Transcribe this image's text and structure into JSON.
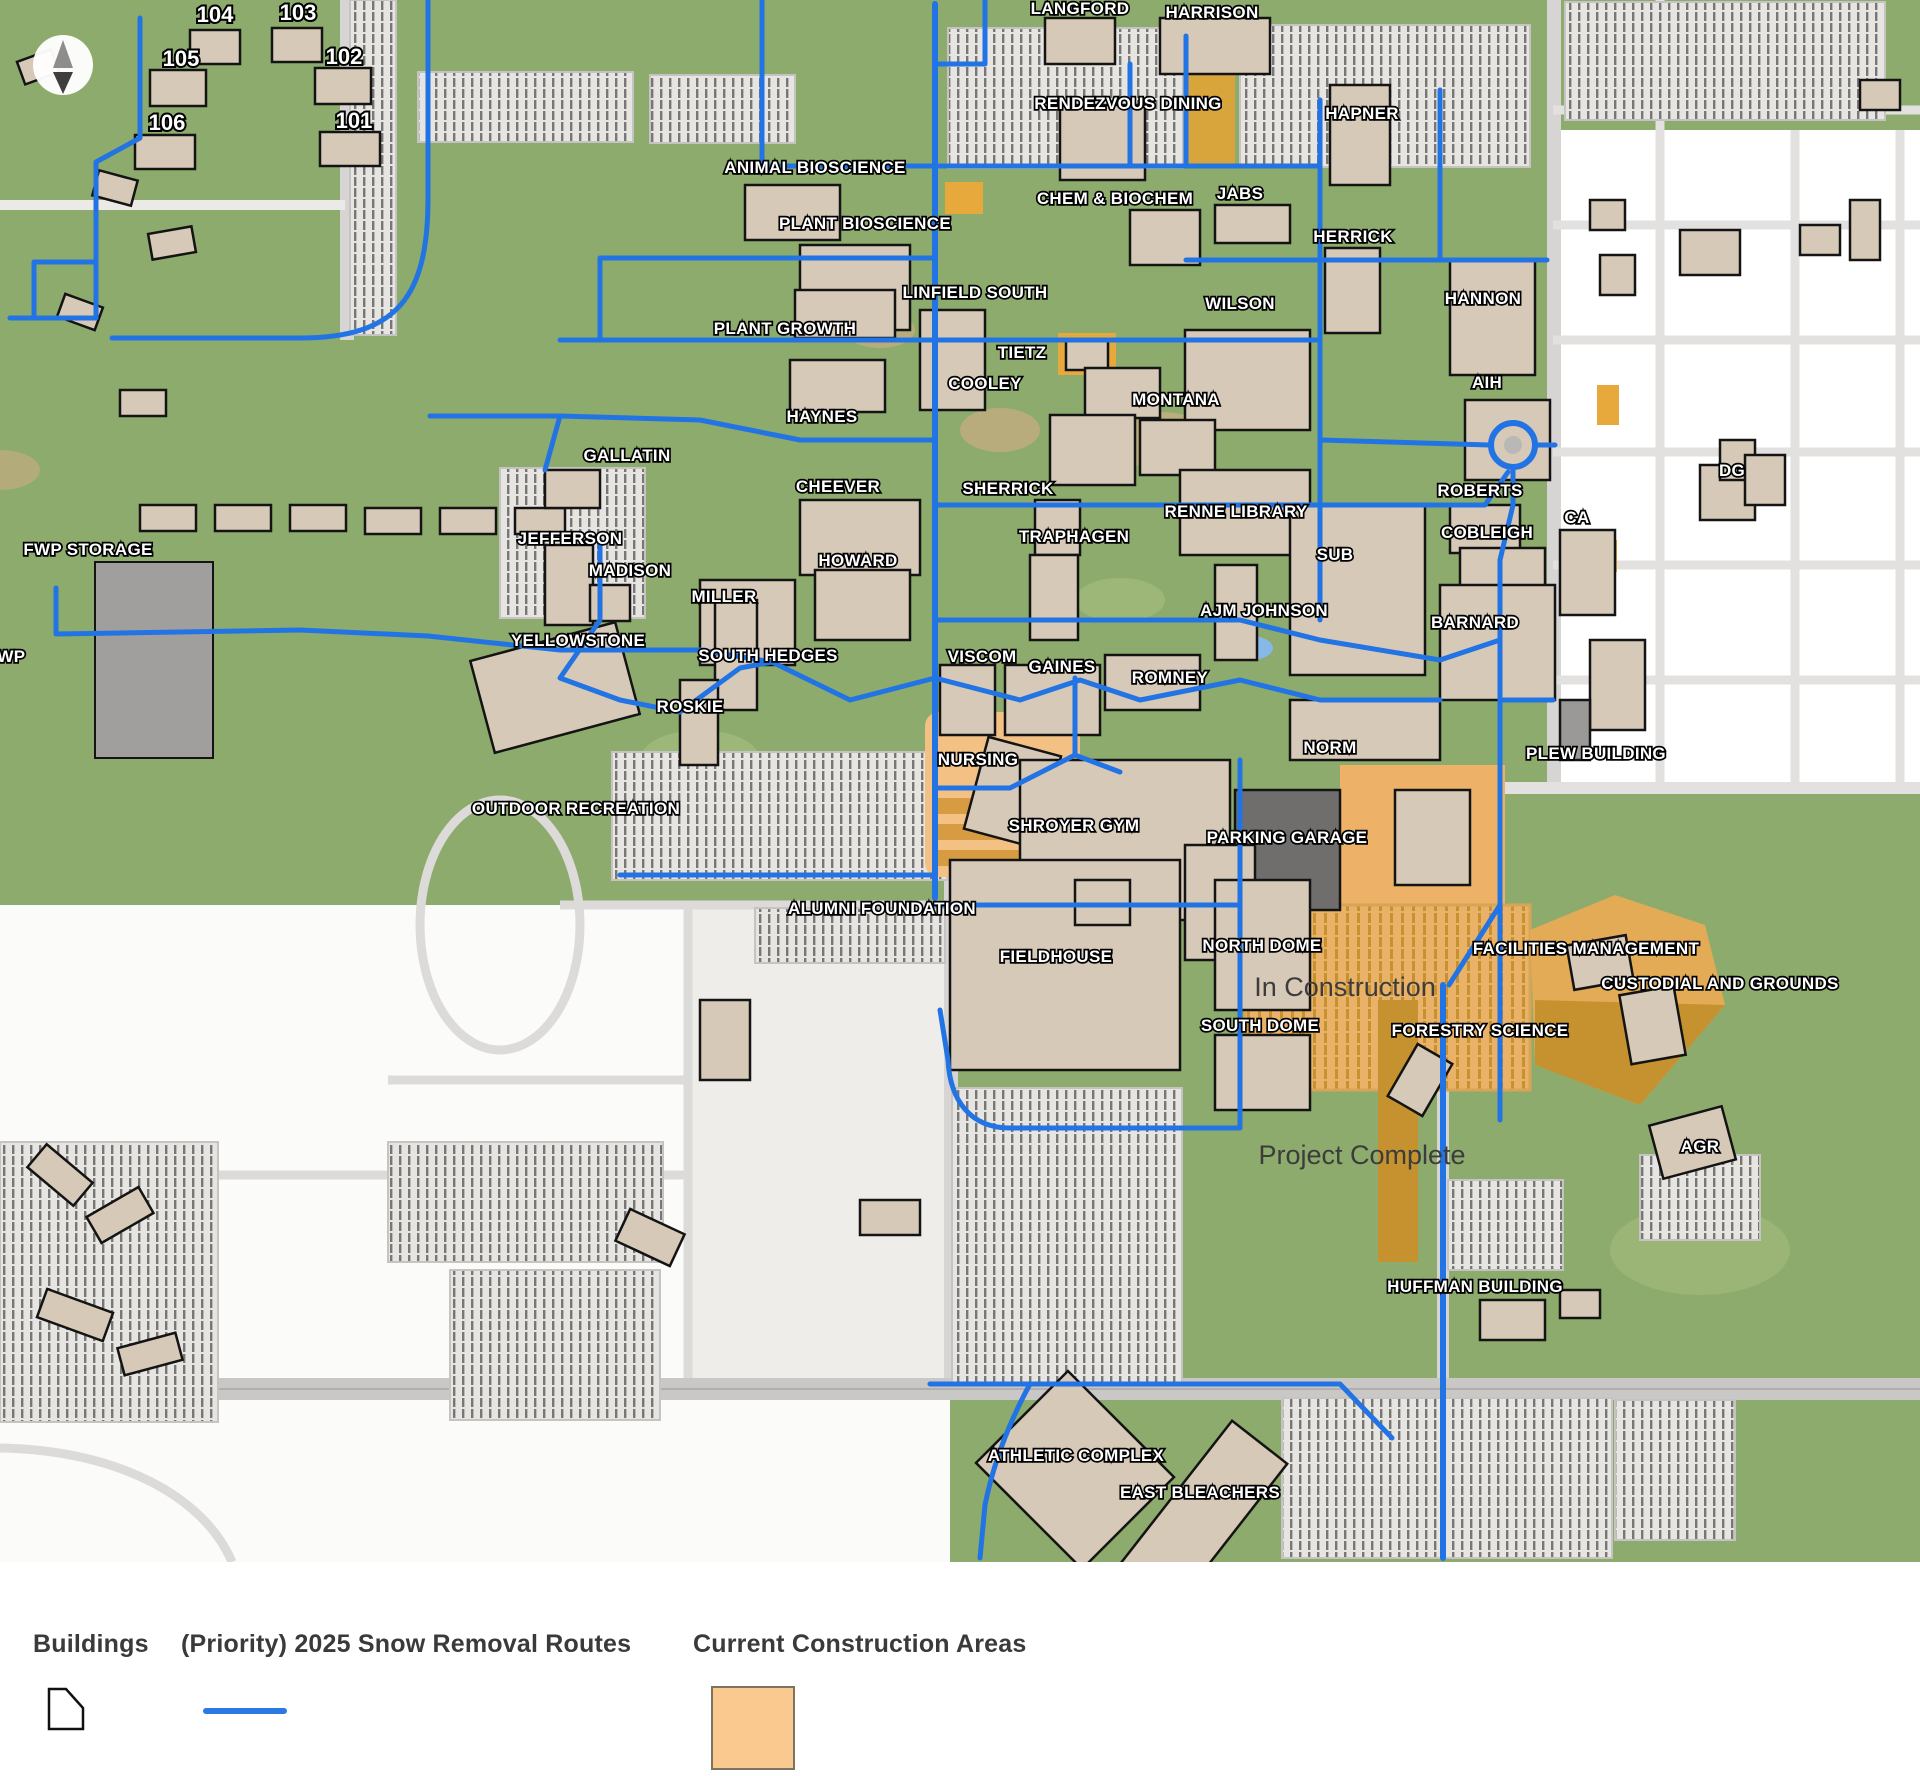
{
  "map": {
    "colors": {
      "campus_green": "#8dab6d",
      "route_blue": "#2274e4",
      "building_tan": "#d7c9b8",
      "construction_light": "#f4c184",
      "construction_mid": "#e9b268",
      "construction_dark": "#c5922f",
      "street_gray": "#d6d5d3",
      "parking_gray": "#e7e5e2"
    },
    "labels": [
      {
        "t": "104",
        "x": 215,
        "y": 16,
        "k": "n"
      },
      {
        "t": "103",
        "x": 298,
        "y": 14,
        "k": "n"
      },
      {
        "t": "105",
        "x": 181,
        "y": 60,
        "k": "n"
      },
      {
        "t": "102",
        "x": 344,
        "y": 58,
        "k": "n"
      },
      {
        "t": "106",
        "x": 167,
        "y": 124,
        "k": "n"
      },
      {
        "t": "101",
        "x": 354,
        "y": 122,
        "k": "n"
      },
      {
        "t": "LANGFORD",
        "x": 1080,
        "y": 8,
        "k": "b"
      },
      {
        "t": "HARRISON",
        "x": 1212,
        "y": 12,
        "k": "b"
      },
      {
        "t": "RENDEZVOUS DINING",
        "x": 1128,
        "y": 103,
        "k": "b"
      },
      {
        "t": "HAPNER",
        "x": 1362,
        "y": 113,
        "k": "b"
      },
      {
        "t": "ANIMAL BIOSCIENCE",
        "x": 815,
        "y": 167,
        "k": "b"
      },
      {
        "t": "CHEM & BIOCHEM",
        "x": 1115,
        "y": 198,
        "k": "b"
      },
      {
        "t": "JABS",
        "x": 1240,
        "y": 193,
        "k": "b"
      },
      {
        "t": "PLANT BIOSCIENCE",
        "x": 865,
        "y": 223,
        "k": "b"
      },
      {
        "t": "HERRICK",
        "x": 1353,
        "y": 236,
        "k": "b"
      },
      {
        "t": "LINFIELD SOUTH",
        "x": 975,
        "y": 292,
        "k": "b"
      },
      {
        "t": "WILSON",
        "x": 1240,
        "y": 303,
        "k": "b"
      },
      {
        "t": "HANNON",
        "x": 1483,
        "y": 298,
        "k": "b"
      },
      {
        "t": "PLANT GROWTH",
        "x": 785,
        "y": 328,
        "k": "b"
      },
      {
        "t": "TIETZ",
        "x": 1022,
        "y": 352,
        "k": "b"
      },
      {
        "t": "COOLEY",
        "x": 985,
        "y": 383,
        "k": "b"
      },
      {
        "t": "MONTANA",
        "x": 1176,
        "y": 399,
        "k": "b"
      },
      {
        "t": "AIH",
        "x": 1487,
        "y": 382,
        "k": "b"
      },
      {
        "t": "HAYNES",
        "x": 822,
        "y": 416,
        "k": "b"
      },
      {
        "t": "GALLATIN",
        "x": 627,
        "y": 455,
        "k": "b"
      },
      {
        "t": "CHEEVER",
        "x": 838,
        "y": 486,
        "k": "b"
      },
      {
        "t": "SHERRICK",
        "x": 1008,
        "y": 488,
        "k": "b"
      },
      {
        "t": "RENNE LIBRARY",
        "x": 1236,
        "y": 511,
        "k": "b"
      },
      {
        "t": "ROBERTS",
        "x": 1480,
        "y": 490,
        "k": "b"
      },
      {
        "t": "TRAPHAGEN",
        "x": 1074,
        "y": 536,
        "k": "b"
      },
      {
        "t": "COBLEIGH",
        "x": 1487,
        "y": 532,
        "k": "b"
      },
      {
        "t": "CA",
        "x": 1577,
        "y": 517,
        "k": "b"
      },
      {
        "t": "DG",
        "x": 1732,
        "y": 470,
        "k": "b"
      },
      {
        "t": "FWP STORAGE",
        "x": 88,
        "y": 549,
        "k": "b"
      },
      {
        "t": "JEFFERSON",
        "x": 570,
        "y": 538,
        "k": "b"
      },
      {
        "t": "MADISON",
        "x": 630,
        "y": 570,
        "k": "b"
      },
      {
        "t": "HOWARD",
        "x": 858,
        "y": 560,
        "k": "b"
      },
      {
        "t": "SUB",
        "x": 1335,
        "y": 554,
        "k": "b"
      },
      {
        "t": "MILLER",
        "x": 724,
        "y": 596,
        "k": "b"
      },
      {
        "t": "AJM JOHNSON",
        "x": 1264,
        "y": 610,
        "k": "b"
      },
      {
        "t": "BARNARD",
        "x": 1475,
        "y": 622,
        "k": "b"
      },
      {
        "t": "FWP",
        "x": 6,
        "y": 656,
        "k": "b"
      },
      {
        "t": "YELLOWSTONE",
        "x": 578,
        "y": 640,
        "k": "b"
      },
      {
        "t": "SOUTH HEDGES",
        "x": 768,
        "y": 655,
        "k": "b"
      },
      {
        "t": "VISCOM",
        "x": 982,
        "y": 656,
        "k": "b"
      },
      {
        "t": "GAINES",
        "x": 1062,
        "y": 666,
        "k": "b"
      },
      {
        "t": "ROMNEY",
        "x": 1170,
        "y": 677,
        "k": "b"
      },
      {
        "t": "ROSKIE",
        "x": 690,
        "y": 706,
        "k": "b"
      },
      {
        "t": "NORM",
        "x": 1330,
        "y": 747,
        "k": "b"
      },
      {
        "t": "PLEW BUILDING",
        "x": 1596,
        "y": 753,
        "k": "b"
      },
      {
        "t": "NURSING",
        "x": 978,
        "y": 759,
        "k": "b"
      },
      {
        "t": "OUTDOOR RECREATION",
        "x": 576,
        "y": 808,
        "k": "b"
      },
      {
        "t": "SHROYER GYM",
        "x": 1074,
        "y": 825,
        "k": "b"
      },
      {
        "t": "PARKING GARAGE",
        "x": 1287,
        "y": 837,
        "k": "b"
      },
      {
        "t": "ALUMNI FOUNDATION",
        "x": 882,
        "y": 908,
        "k": "b"
      },
      {
        "t": "FIELDHOUSE",
        "x": 1056,
        "y": 956,
        "k": "b"
      },
      {
        "t": "NORTH DOME",
        "x": 1262,
        "y": 945,
        "k": "b"
      },
      {
        "t": "FACILITIES MANAGEMENT",
        "x": 1586,
        "y": 948,
        "k": "b"
      },
      {
        "t": "In Construction",
        "x": 1345,
        "y": 990,
        "k": "s"
      },
      {
        "t": "CUSTODIAL AND GROUNDS",
        "x": 1720,
        "y": 983,
        "k": "b"
      },
      {
        "t": "SOUTH DOME",
        "x": 1260,
        "y": 1025,
        "k": "b"
      },
      {
        "t": "FORESTRY SCIENCE",
        "x": 1480,
        "y": 1030,
        "k": "b"
      },
      {
        "t": "Project Complete",
        "x": 1362,
        "y": 1158,
        "k": "s"
      },
      {
        "t": "AGR",
        "x": 1700,
        "y": 1146,
        "k": "b"
      },
      {
        "t": "HUFFMAN BUILDING",
        "x": 1475,
        "y": 1286,
        "k": "b"
      },
      {
        "t": "ATHLETIC COMPLEX",
        "x": 1076,
        "y": 1455,
        "k": "b"
      },
      {
        "t": "EAST BLEACHERS",
        "x": 1200,
        "y": 1492,
        "k": "b"
      }
    ]
  },
  "legend": {
    "items": [
      {
        "label": "Buildings",
        "swatch": "building"
      },
      {
        "label": "(Priority) 2025 Snow Removal Routes",
        "swatch": "route"
      },
      {
        "label": "Current Construction Areas",
        "swatch": "construction"
      }
    ]
  }
}
